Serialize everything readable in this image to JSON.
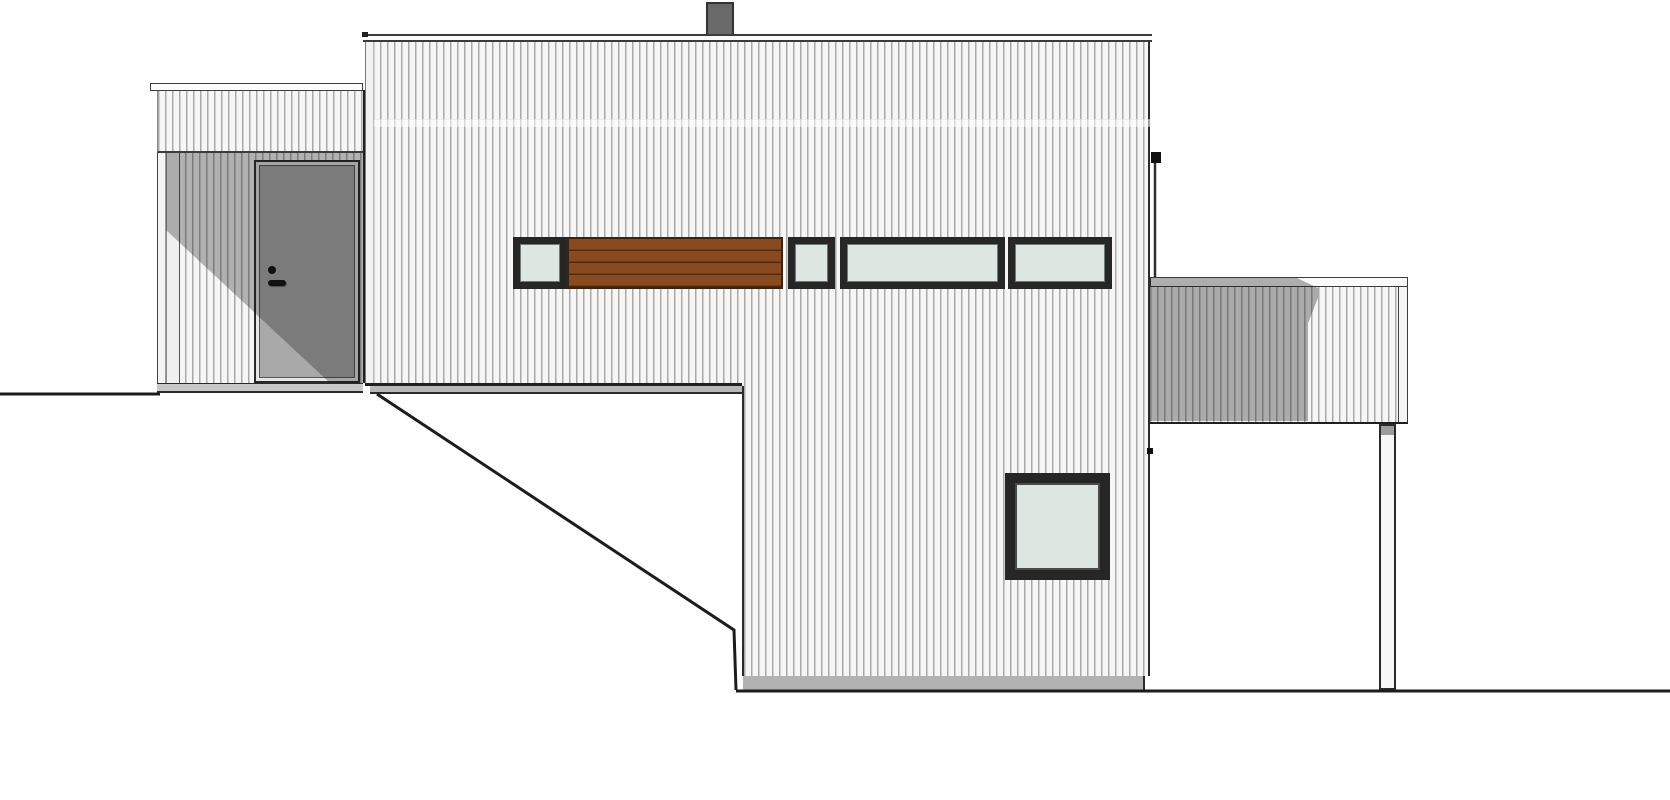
{
  "drawing": {
    "kind": "house side elevation drawing",
    "visible_components": [
      "chimney",
      "flat-roof-fascia",
      "vertical-wood-siding",
      "entrance-porch",
      "entry-door",
      "door-knob",
      "door-handle",
      "clerestory-window-band",
      "wood-slat-panel",
      "square-window",
      "deck-railing",
      "deck-support-post",
      "downspout",
      "ground-line-left",
      "ground-line-right",
      "terrain-slope-line",
      "foundation-strip"
    ]
  },
  "colors": {
    "background": "#ffffff",
    "siding_light": "#f6f6f6",
    "siding_line": "#a9a9a9",
    "fascia_white": "#fbfbfb",
    "outline_dark": "#1f1f1f",
    "shadow_overlay": "rgba(18,18,18,0.30)",
    "door_panel": "#a9a9a9",
    "door_hardware": "#111111",
    "glass": "#dde6e1",
    "window_frame": "#262626",
    "wood_panel": "#8a4a1f",
    "wood_slat_line": "#4f2c10",
    "chimney": "#696969",
    "soffit_gray": "#b8b8b8",
    "foundation_gray": "#b2b2b2",
    "post_cap_gray": "#9c9c9c"
  }
}
